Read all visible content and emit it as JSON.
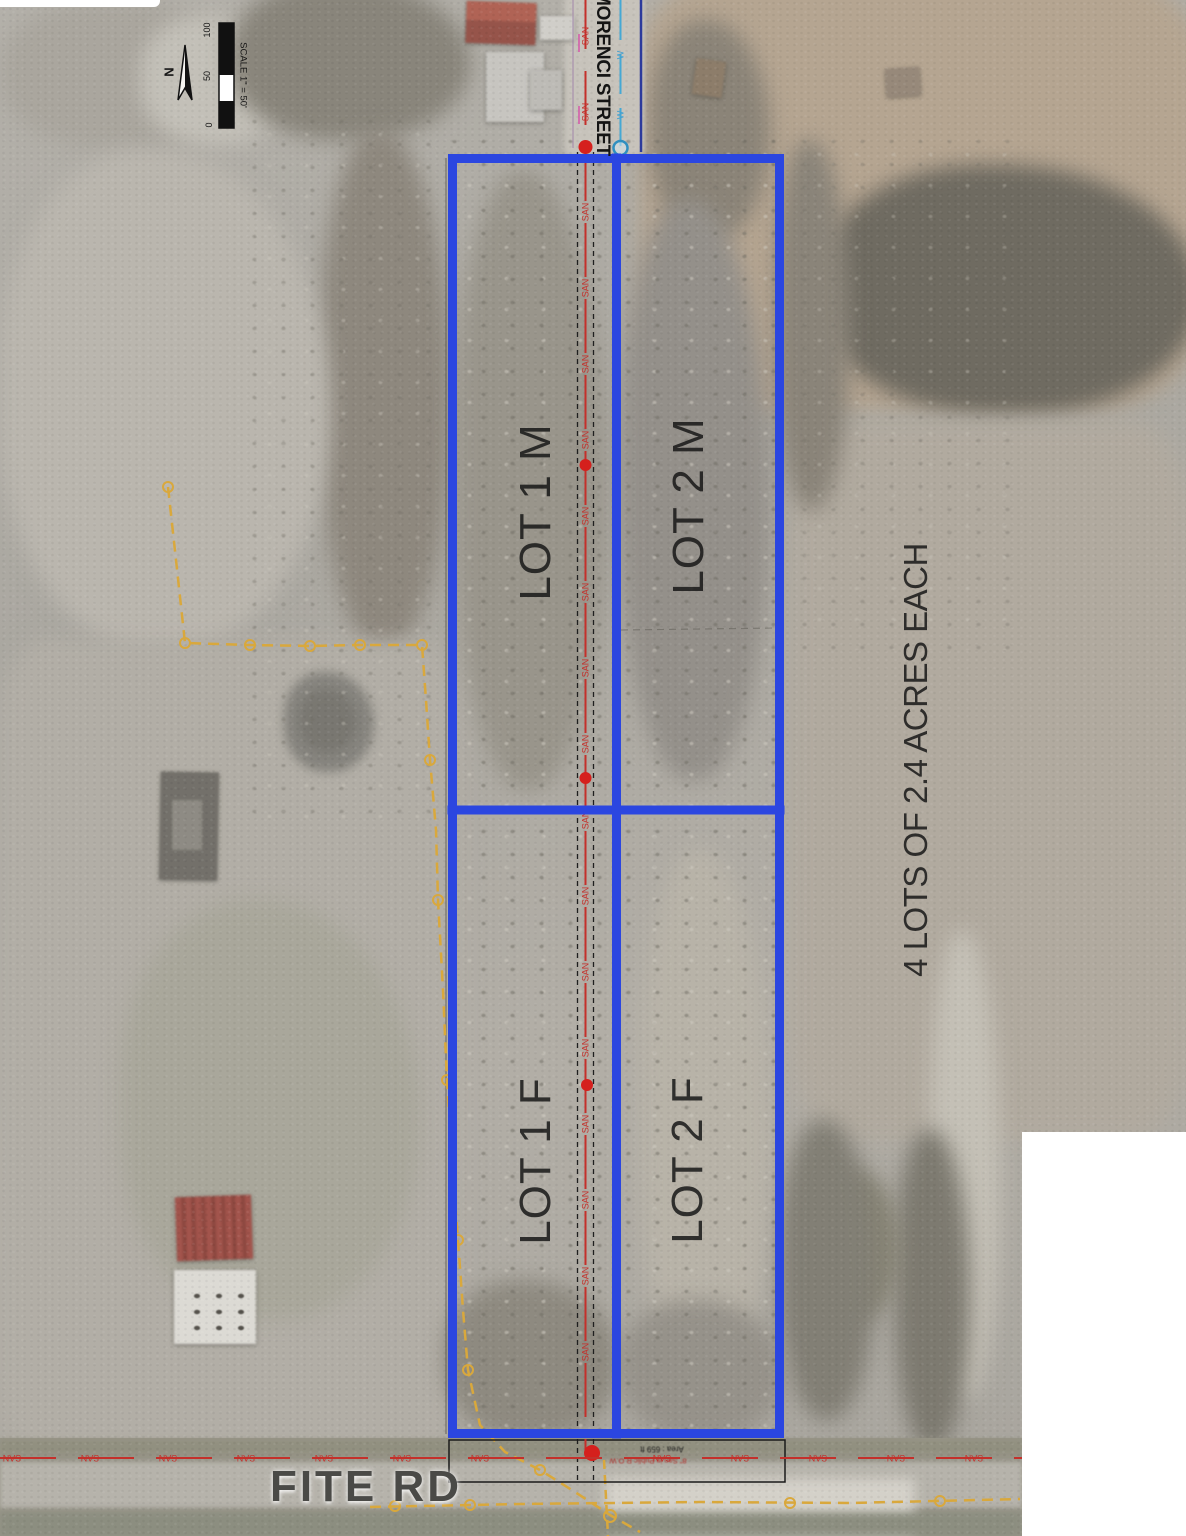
{
  "map": {
    "scale": {
      "label": "SCALE 1\" = 50'",
      "ticks": {
        "zero": "0",
        "fifty": "50",
        "hundred": "100"
      }
    },
    "north_label": "N",
    "streets": {
      "morenci": "MORENCI STREET",
      "fite": "FITE RD"
    },
    "lots": {
      "lot1m": "LOT 1 M",
      "lot2m": "LOT 2 M",
      "lot1f": "LOT 1 F",
      "lot2f": "LOT 2 F"
    },
    "note": "4 LOTS OF 2.4 ACRES EACH",
    "utilities": {
      "sanitary_label": "SAN",
      "water_label": "W",
      "row_area_note": "Area : 659 ft",
      "row_dedication_note": "8\" San in Public R.O.W"
    },
    "colors": {
      "boundary_blue": "#2b46e0",
      "sewer_red": "#c4302b",
      "water_cyan": "#3f9fd0",
      "casing_blue": "#2c3a9c",
      "gas_yellow": "#d9a83c"
    }
  }
}
